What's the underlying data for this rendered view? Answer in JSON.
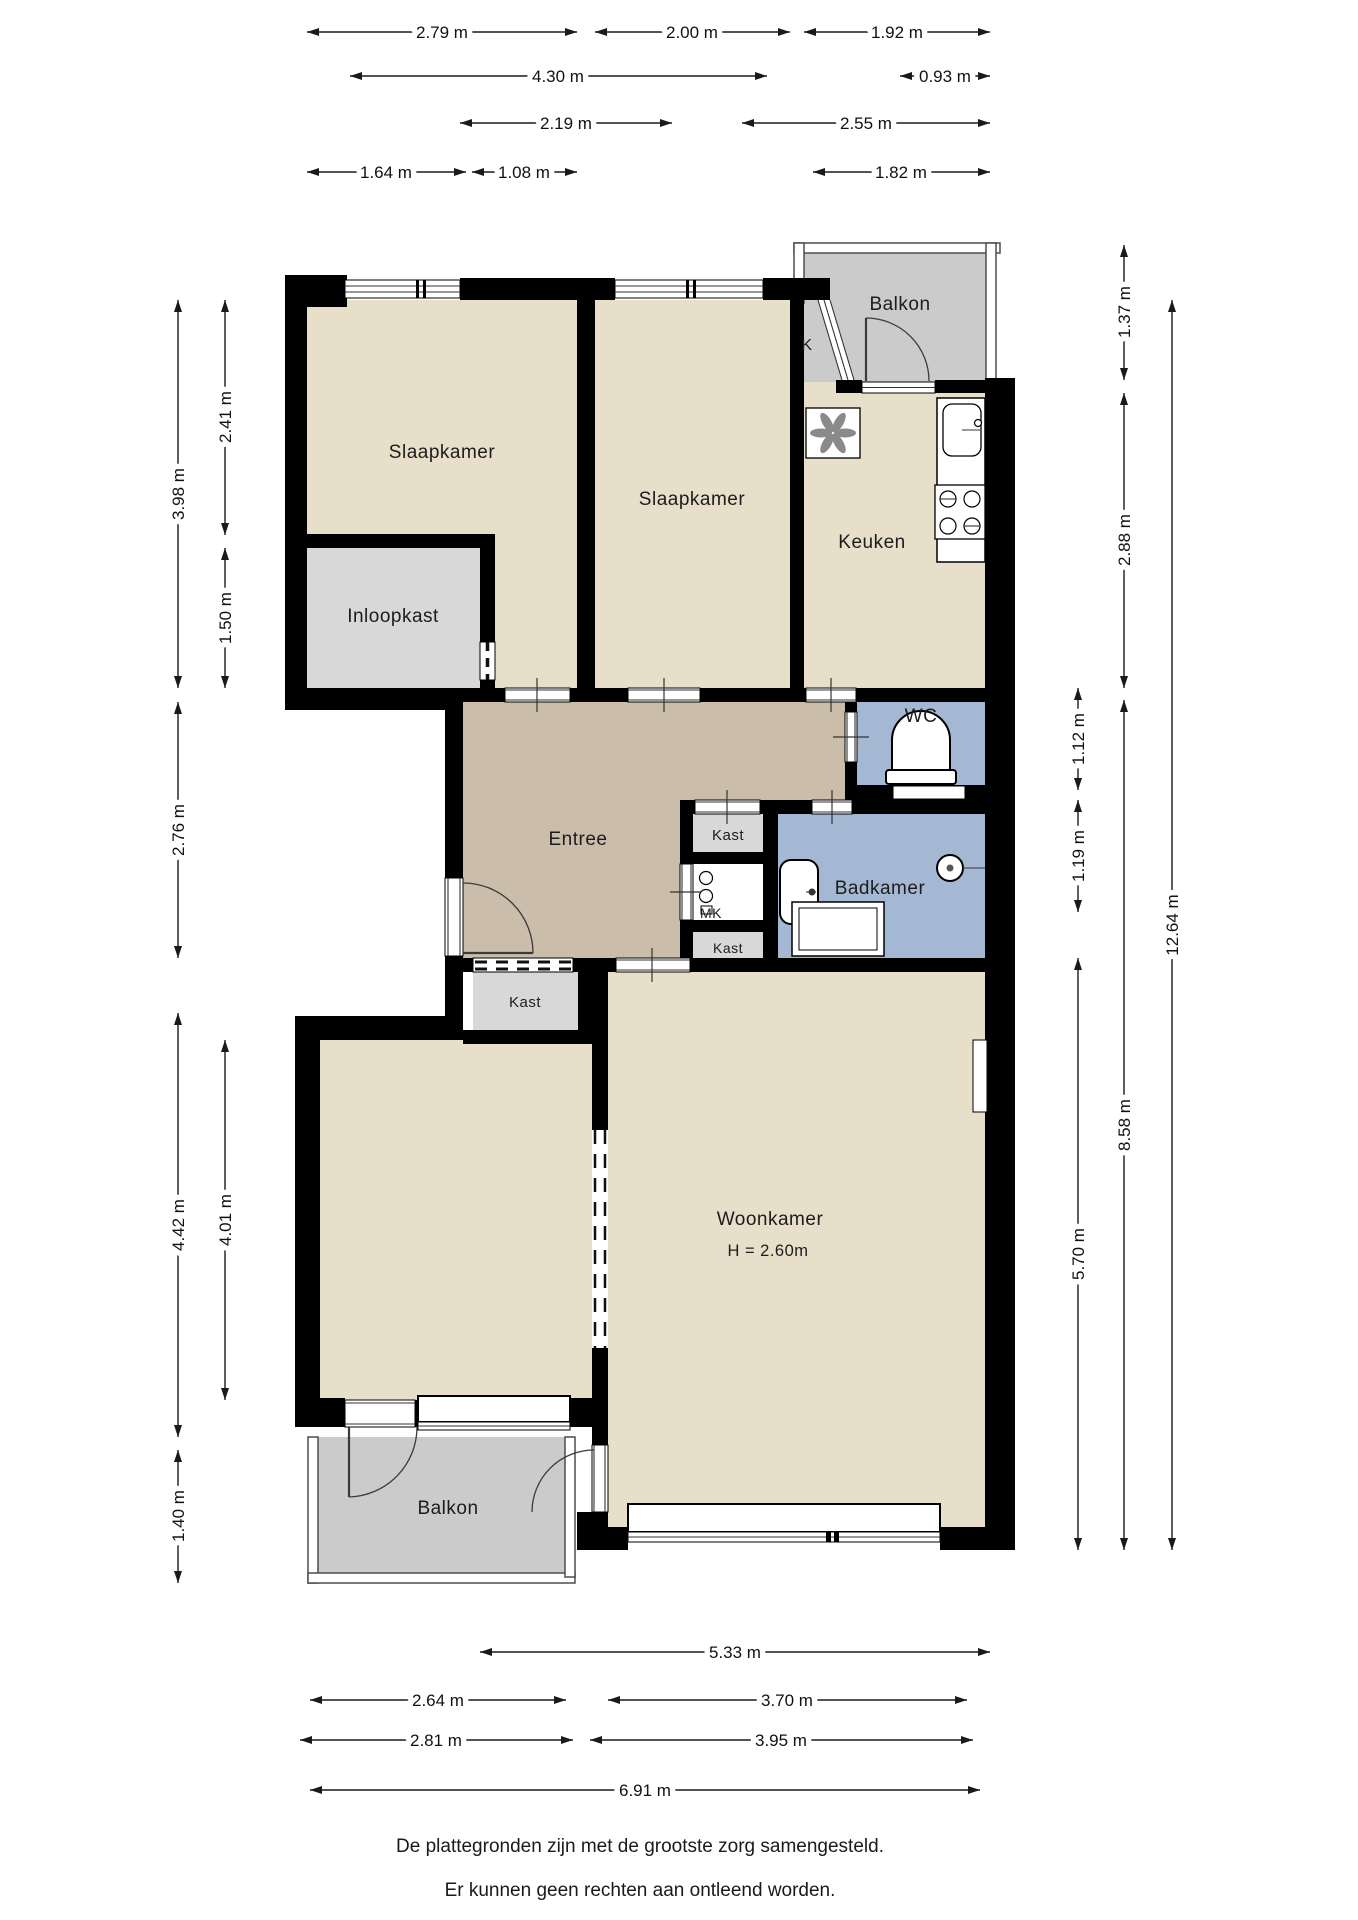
{
  "rooms": {
    "slaapkamer1": "Slaapkamer",
    "slaapkamer2": "Slaapkamer",
    "inloopkast": "Inloopkast",
    "keuken": "Keuken",
    "balkon_top": "Balkon",
    "k_label": "K",
    "wc": "WC",
    "badkamer": "Badkamer",
    "entree": "Entree",
    "kast_top": "Kast",
    "mk": "MK",
    "kast_bottom": "Kast",
    "kast_left": "Kast",
    "woonkamer": "Woonkamer",
    "woonkamer_height": "H = 2.60m",
    "balkon_bottom": "Balkon"
  },
  "dims": {
    "top": [
      "2.79 m",
      "2.00 m",
      "1.92 m",
      "4.30 m",
      "0.93 m",
      "2.19 m",
      "2.55 m",
      "1.64 m",
      "1.08 m",
      "1.82 m"
    ],
    "bottom": [
      "5.33 m",
      "2.64 m",
      "3.70 m",
      "2.81 m",
      "3.95 m",
      "6.91 m"
    ],
    "left": [
      "3.98 m",
      "2.41 m",
      "1.50 m",
      "2.76 m",
      "4.42 m",
      "4.01 m",
      "1.40 m"
    ],
    "right": [
      "1.37 m",
      "2.88 m",
      "1.12 m",
      "1.19 m",
      "8.58 m",
      "5.70 m",
      "12.64 m"
    ]
  },
  "footer": {
    "line1": "De plattegronden zijn met de grootste zorg samengesteld.",
    "line2": "Er kunnen geen rechten aan ontleend worden."
  },
  "colors": {
    "wall": "#000000",
    "room_cream": "#e7dfc9",
    "entree_tan": "#cabda9",
    "wet_blue": "#a5b8d3",
    "balcony_grey": "#cbcbcb",
    "closet_grey": "#d8d8d8",
    "mk_white": "#ffffff"
  }
}
